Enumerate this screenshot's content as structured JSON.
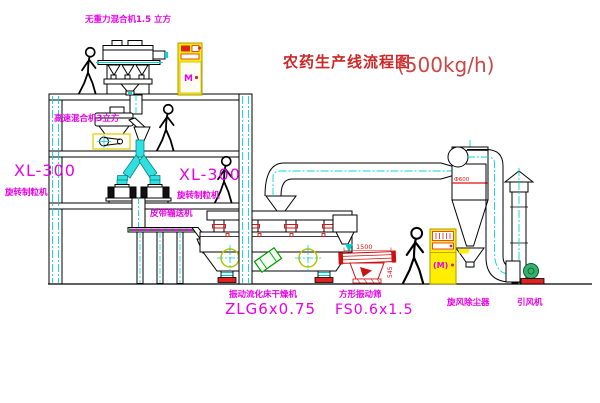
{
  "title": {
    "text": "农药生产线流程图",
    "capacity": "(500kg/h)"
  },
  "equipment": {
    "gravity_mixer": {
      "label": "无重力混合机1.5 立方"
    },
    "high_speed_mixer": {
      "label": "高速混合机3立方"
    },
    "granulator_left": {
      "model": "XL-300",
      "label": "旋转制粒机"
    },
    "granulator_center": {
      "model": "XL-300",
      "label": "旋转制粒机"
    },
    "belt_conveyor": {
      "label": "皮带输送机"
    },
    "fluid_bed_dryer": {
      "label": "振动流化床干燥机",
      "model": "ZLG6x0.75"
    },
    "vibrating_screen": {
      "label": "方形振动筛",
      "model": "FS0.6x1.5",
      "dim_length": "1500",
      "dim_height": "545"
    },
    "cyclone": {
      "label": "旋风除尘器",
      "flange_dia": "Ф600"
    },
    "induced_draft_fan": {
      "label": "引风机"
    },
    "control_cabinet_top": {
      "symbol": "M"
    },
    "control_cabinet_right": {
      "symbol": "(M)"
    }
  },
  "colors": {
    "line": "#000000",
    "centerline_cyan": "#00d8d8",
    "label_magenta": "#e800e8",
    "title_red": "#cc2626",
    "capacity_red": "#cc4545",
    "accent_red": "#dd1111",
    "cabinet_yellow": "#ffee00",
    "motor_green": "#009900",
    "belt_green": "#00aa00",
    "circle_olive": "#b8c400"
  }
}
